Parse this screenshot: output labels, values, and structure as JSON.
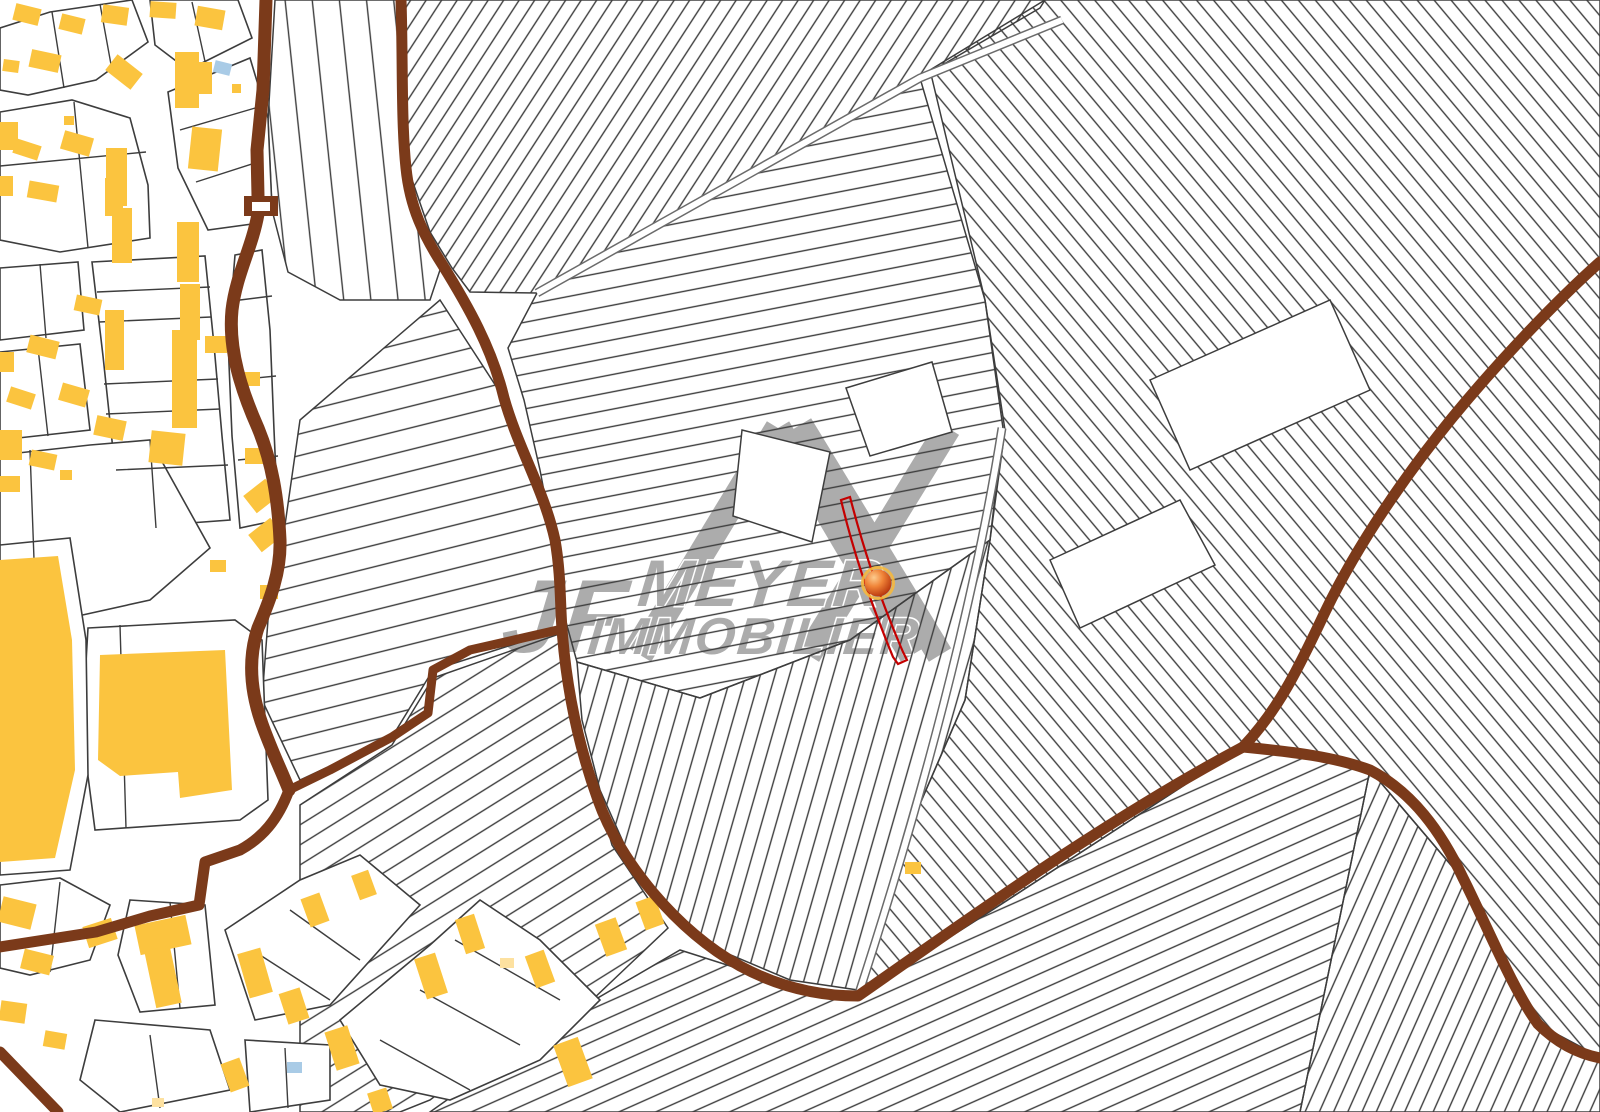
{
  "map": {
    "background": "#ffffff",
    "colors": {
      "building": "#FBC43F",
      "building_light": "#FDE1A0",
      "building_blue": "#A9CBE6",
      "road_brown": "#7B3A1A",
      "parcel_line": "#3D3D3D",
      "lane_edge": "#6B6B6B",
      "selected_red": "#C40000",
      "watermark_gray": "#ACACAC",
      "marker_ring": "#F5B83D"
    },
    "watermark": {
      "initials": "JF",
      "line1": "MEYER",
      "line2": "IMMOBILIER",
      "logo_strokes": [
        "M640,655 L778,428",
        "M778,428 L912,655",
        "M948,428 L808,655",
        "M800,425 L940,655"
      ]
    },
    "marker": {
      "x": 878,
      "y": 583,
      "r": 13.5,
      "ring_r": 15.5
    },
    "selected_parcel": {
      "path": "M841,500 L850,497 C862,543 876,589 903,652 L907,660 L898,664 L893,657 C866,591 852,546 841,500 Z"
    },
    "regions": [
      {
        "name": "strips-top-center",
        "points": "404,0 1045,0 1040,8 920,78 537,293 470,292 452,268 430,232 408,168",
        "angle": 33,
        "spacing": 13
      },
      {
        "name": "strips-center-horizontal",
        "points": "537,293 920,78 985,300 1003,428 990,540 850,640 700,698 577,662 560,600 552,534 540,470 524,400 508,348",
        "angle": 79,
        "spacing": 17
      },
      {
        "name": "strips-right",
        "points": "930,70 1045,0 1600,0 1600,1057 1538,1024 1462,878 1370,770 1243,747 1000,905 858,996 900,850 965,700 990,540 1005,430 985,300",
        "angle": -40,
        "spacing": 13
      },
      {
        "name": "strips-center-fan",
        "points": "577,662 700,698 850,640 990,540 965,700 900,850 858,990 790,980 700,942 640,880 600,790 582,720",
        "angle": 16,
        "spacing": 14
      },
      {
        "name": "strips-bottom-center",
        "points": "430,1112 560,1020 680,950 790,985 858,996 1000,905 1243,747 1370,770 1300,1112",
        "angle": 66,
        "spacing": 15
      },
      {
        "name": "strips-bottom-right",
        "points": "1300,1112 1370,770 1462,878 1538,1024 1600,1058 1600,1112",
        "angle": 24,
        "spacing": 13
      },
      {
        "name": "strips-left-top",
        "points": "275,0 401,0 405,168 424,236 442,264 430,300 340,300 288,272 272,210 268,120",
        "angle": -6,
        "spacing": 27
      },
      {
        "name": "strips-left-middle",
        "points": "300,420 440,300 505,400 556,540 562,629 433,670 392,737 300,780 262,700 268,620 280,560",
        "angle": 76,
        "spacing": 21
      },
      {
        "name": "strips-left-bottom",
        "points": "300,805 392,745 433,678 562,633 580,730 612,845 668,928 590,1002 480,1062 430,1100 400,1112 300,1112",
        "angle": 58,
        "spacing": 17
      }
    ],
    "lanes": [
      {
        "name": "field-lane-upper",
        "d": "M537,293 L920,78 L1062,20"
      },
      {
        "name": "field-lane-fan-edge",
        "d": "M1002,428 C986,530 948,720 858,996"
      }
    ],
    "white_parcels": [
      {
        "points": "742,430 830,452 812,542 733,516"
      },
      {
        "points": "846,388 932,362 952,432 870,456"
      },
      {
        "points": "1150,380 1330,300 1370,390 1190,470"
      },
      {
        "points": "1050,560 1180,500 1215,565 1080,628"
      }
    ],
    "roads": [
      {
        "name": "road-left-vertical",
        "w": 13,
        "d": "M266,0 L263,90 L257,150 L258,196 M258,214 C252,248 236,275 232,310 C228,350 242,392 258,428 C272,462 278,498 280,540 C281,572 270,600 258,628 C248,658 250,690 262,724 C272,752 282,772 289,790"
      },
      {
        "name": "road-zigzag-connector",
        "w": 9,
        "d": "M289,790 L330,770 L392,737 L428,713 L433,670 L470,650 L562,629"
      },
      {
        "name": "road-left-bottom",
        "w": 11,
        "d": "M289,790 C278,820 262,838 240,850 L205,862 L199,905 L150,916 L96,932 L0,947"
      },
      {
        "name": "road-corner-bottom-left",
        "w": 11,
        "d": "M0,1052 L58,1112"
      },
      {
        "name": "road-central-curve",
        "w": 11,
        "d": "M401,0 C403,60 401,120 406,168 C410,208 424,236 442,264 C468,306 492,348 504,398 C518,448 544,490 555,540 C561,574 560,604 562,629 C566,684 577,742 598,800 C620,862 676,930 740,966 C788,992 830,996 858,996 C960,925 1100,823 1243,747"
      },
      {
        "name": "road-top-right",
        "w": 11,
        "d": "M1600,262 C1555,302 1498,362 1452,418 C1408,472 1360,540 1326,610 C1303,658 1282,706 1243,747"
      },
      {
        "name": "road-bottom-right",
        "w": 11,
        "d": "M1243,747 C1295,752 1335,757 1370,770 C1412,792 1441,831 1463,878 C1488,928 1512,988 1538,1024 C1558,1044 1580,1054 1600,1058"
      }
    ],
    "road_collar": {
      "outer": [
        244,
        196,
        34,
        20
      ],
      "inner": [
        252,
        202,
        18,
        9
      ]
    },
    "blocks": [
      {
        "points": "0,28 50,12 132,0 148,42 96,80 28,95 0,90"
      },
      {
        "points": "150,0 238,0 252,38 188,70 155,45"
      },
      {
        "points": "0,112 72,100 130,118 148,185 150,238 60,252 0,240"
      },
      {
        "points": "168,92 250,58 268,118 272,208 252,224 208,230 178,168"
      },
      {
        "points": "92,262 205,256 214,345 222,436 230,520 122,528 113,450 103,356"
      },
      {
        "points": "0,268 78,262 84,330 0,340"
      },
      {
        "points": "0,352 80,344 90,430 0,440"
      },
      {
        "points": "235,255 262,250 270,330 274,430 278,520 240,528 232,436 228,340"
      },
      {
        "points": "0,455 90,445 150,440 210,548 150,600 60,620 0,612"
      },
      {
        "points": "88,628 235,620 262,640 268,800 240,820 95,830 82,730"
      },
      {
        "points": "0,545 70,538 86,640 88,775 70,870 0,875"
      },
      {
        "points": "0,885 60,878 110,905 90,960 30,975 0,968"
      },
      {
        "points": "130,900 205,905 215,1005 140,1012 118,955"
      },
      {
        "points": "225,930 300,880 360,855 420,905 330,1005 255,1020"
      },
      {
        "points": "340,1020 430,945 480,900 540,940 600,1000 540,1060 450,1100 380,1085"
      },
      {
        "points": "95,1020 210,1030 230,1090 120,1112 80,1080"
      },
      {
        "points": "245,1040 330,1045 330,1100 250,1112"
      }
    ],
    "dividers": "M52,12 L64,88 M100,4 L112,70 M192,2 L206,66 M0,166 L146,152 M74,102 L88,248 M180,130 L262,106 M196,182 L258,162 M97,292 L210,287 M99,322 L211,317 M104,384 L218,379 M106,414 L220,409 M116,470 L228,465 M40,264 L46,338 M38,348 L48,436 M240,300 L272,296 M236,380 L276,376 M238,460 L278,456 M120,625 L126,828 M30,450 L36,614 M150,440 L156,528 M60,882 L50,972 M170,902 L180,1008 M260,955 L330,1000 M290,910 L360,960 M380,1040 L470,1090 M420,990 L520,1045 M455,940 L560,1000 M150,1035 L160,1108 M285,1048 L288,1108",
    "buildings": [
      [
        14,
        6,
        26,
        17,
        14,
        "y"
      ],
      [
        60,
        16,
        24,
        16,
        14,
        "y"
      ],
      [
        102,
        6,
        26,
        18,
        8,
        "y"
      ],
      [
        150,
        2,
        26,
        16,
        4,
        "y"
      ],
      [
        196,
        8,
        28,
        20,
        10,
        "y"
      ],
      [
        3,
        60,
        16,
        12,
        8,
        "y"
      ],
      [
        30,
        52,
        30,
        18,
        12,
        "y"
      ],
      [
        108,
        62,
        32,
        20,
        38,
        "y"
      ],
      [
        64,
        116,
        10,
        9,
        0,
        "y"
      ],
      [
        188,
        62,
        24,
        32,
        0,
        "y"
      ],
      [
        214,
        62,
        17,
        12,
        14,
        "b"
      ],
      [
        232,
        84,
        9,
        9,
        0,
        "y"
      ],
      [
        175,
        52,
        24,
        56,
        0,
        "y"
      ],
      [
        190,
        128,
        30,
        42,
        6,
        "y"
      ],
      [
        0,
        122,
        18,
        28,
        0,
        "y"
      ],
      [
        14,
        142,
        26,
        15,
        18,
        "y"
      ],
      [
        62,
        134,
        30,
        19,
        16,
        "y"
      ],
      [
        28,
        183,
        30,
        17,
        10,
        "y"
      ],
      [
        0,
        176,
        13,
        20,
        0,
        "y"
      ],
      [
        105,
        178,
        18,
        38,
        0,
        "y"
      ],
      [
        106,
        148,
        21,
        58,
        0,
        "y"
      ],
      [
        112,
        208,
        20,
        55,
        0,
        "y"
      ],
      [
        177,
        222,
        22,
        60,
        0,
        "y"
      ],
      [
        180,
        284,
        20,
        56,
        0,
        "y"
      ],
      [
        75,
        297,
        26,
        16,
        12,
        "y"
      ],
      [
        28,
        338,
        30,
        18,
        14,
        "y"
      ],
      [
        0,
        352,
        14,
        20,
        0,
        "y"
      ],
      [
        8,
        390,
        26,
        16,
        18,
        "y"
      ],
      [
        60,
        386,
        28,
        18,
        16,
        "y"
      ],
      [
        105,
        310,
        19,
        60,
        0,
        "y"
      ],
      [
        172,
        330,
        25,
        98,
        0,
        "y"
      ],
      [
        205,
        336,
        22,
        17,
        0,
        "y"
      ],
      [
        240,
        372,
        20,
        14,
        0,
        "y"
      ],
      [
        95,
        418,
        30,
        20,
        12,
        "y"
      ],
      [
        150,
        432,
        34,
        32,
        6,
        "y"
      ],
      [
        245,
        448,
        22,
        16,
        0,
        "y"
      ],
      [
        247,
        485,
        28,
        22,
        -38,
        "y"
      ],
      [
        252,
        524,
        28,
        22,
        -38,
        "y"
      ],
      [
        210,
        560,
        16,
        12,
        0,
        "y"
      ],
      [
        0,
        430,
        22,
        30,
        0,
        "y"
      ],
      [
        30,
        452,
        26,
        16,
        12,
        "y"
      ],
      [
        0,
        476,
        20,
        16,
        0,
        "y"
      ],
      [
        60,
        470,
        12,
        10,
        0,
        "y"
      ],
      [
        260,
        585,
        18,
        14,
        0,
        "y"
      ],
      [
        0,
        900,
        34,
        26,
        14,
        "y"
      ],
      [
        22,
        952,
        30,
        20,
        14,
        "y"
      ],
      [
        0,
        1002,
        26,
        20,
        8,
        "y"
      ],
      [
        44,
        1032,
        22,
        16,
        10,
        "y"
      ],
      [
        85,
        922,
        30,
        22,
        -18,
        "y"
      ],
      [
        137,
        920,
        52,
        30,
        -12,
        "y"
      ],
      [
        150,
        948,
        26,
        58,
        -12,
        "y"
      ],
      [
        243,
        950,
        24,
        46,
        -16,
        "y"
      ],
      [
        283,
        990,
        22,
        32,
        -18,
        "y"
      ],
      [
        225,
        1060,
        20,
        30,
        -20,
        "y"
      ],
      [
        305,
        895,
        20,
        30,
        -20,
        "y"
      ],
      [
        355,
        872,
        18,
        26,
        -20,
        "y"
      ],
      [
        330,
        1028,
        24,
        40,
        -18,
        "y"
      ],
      [
        370,
        1090,
        20,
        22,
        -18,
        "y"
      ],
      [
        420,
        955,
        22,
        42,
        -18,
        "y"
      ],
      [
        460,
        916,
        20,
        36,
        -18,
        "y"
      ],
      [
        500,
        958,
        14,
        10,
        0,
        "l"
      ],
      [
        287,
        1062,
        15,
        11,
        0,
        "b"
      ],
      [
        152,
        1098,
        12,
        9,
        0,
        "l"
      ],
      [
        530,
        952,
        20,
        34,
        -20,
        "y"
      ],
      [
        560,
        1040,
        26,
        44,
        -20,
        "y"
      ],
      [
        600,
        920,
        22,
        34,
        -20,
        "y"
      ],
      [
        640,
        898,
        20,
        30,
        -20,
        "y"
      ],
      [
        905,
        862,
        16,
        12,
        0,
        "y"
      ]
    ],
    "building_polygons": [
      {
        "points": "100,655 225,650 232,790 180,798 178,772 120,776 98,760"
      },
      {
        "points": "0,560 58,556 72,640 75,770 55,858 0,862"
      }
    ]
  }
}
